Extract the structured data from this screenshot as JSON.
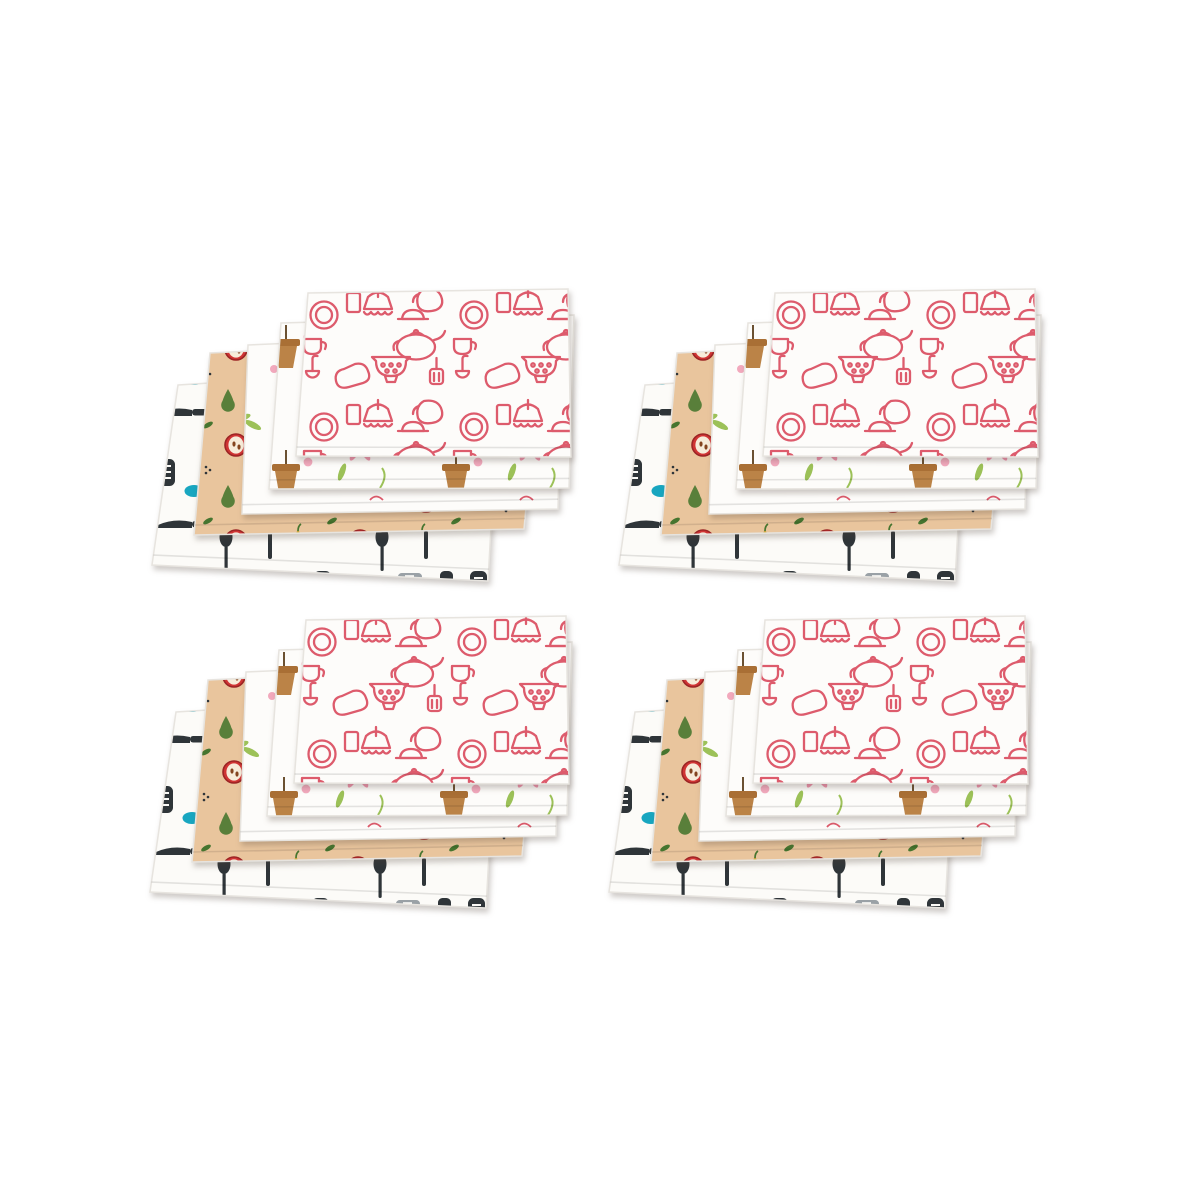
{
  "scene": {
    "background": "#ffffff",
    "subject": "four identical fanned stacks of five printed kitchen towels",
    "grid": "2x2",
    "stack_count": 4,
    "towels_per_stack": 5
  },
  "palette": {
    "towel_white": "#fdfcfa",
    "utensil_bg": "#fcfbf8",
    "jar_white": "#f8f4ec",
    "red_outline": "#dd5b6c",
    "flower_pink": "#f093ad",
    "flower_deep": "#e4647f",
    "tulip_pink": "#e97790",
    "blush_dot": "#f2a9bd",
    "leaf_green": "#9cc158",
    "dark_leaf": "#46752f",
    "pot_brown": "#bb8347",
    "pot_rim": "#a96f35",
    "stick": "#6b5132",
    "sprig_tan": "#dfb183",
    "purple_stripe": "#7b4b90",
    "yellow_stripe": "#c7a23d",
    "beige": "#e9c59d",
    "apple_red": "#d03434",
    "apple_dark": "#9c2424",
    "apple_flesh": "#f7ecda",
    "seed_brown": "#84451f",
    "pear_yellow": "#f1d83e",
    "pear_outline": "#c8a437",
    "pear_green": "#597f3a",
    "charcoal": "#2f3539",
    "utensil_gray": "#9aa1a6",
    "teal": "#18a6c0",
    "hem": "#e7e4df"
  },
  "stacks": [
    {
      "id": "towel-stack-top-left",
      "x": 150,
      "y": 285
    },
    {
      "id": "towel-stack-top-right",
      "x": 617,
      "y": 285
    },
    {
      "id": "towel-stack-bottom-left",
      "x": 148,
      "y": 612
    },
    {
      "id": "towel-stack-bottom-right",
      "x": 607,
      "y": 612
    }
  ],
  "towels": [
    {
      "name": "towel-black-utensils-print",
      "pattern": "utensils",
      "quad": [
        [
          28,
          100
        ],
        [
          350,
          80
        ],
        [
          338,
          296
        ],
        [
          2,
          280
        ]
      ]
    },
    {
      "name": "towel-beige-fruits-print",
      "pattern": "fruits",
      "quad": [
        [
          60,
          68
        ],
        [
          392,
          52
        ],
        [
          374,
          244
        ],
        [
          44,
          250
        ]
      ]
    },
    {
      "name": "towel-white-jars-print",
      "pattern": "jars",
      "quad": [
        [
          98,
          60
        ],
        [
          412,
          46
        ],
        [
          408,
          224
        ],
        [
          92,
          229
        ]
      ]
    },
    {
      "name": "towel-white-floral-print",
      "pattern": "floral",
      "quad": [
        [
          131,
          38
        ],
        [
          424,
          30
        ],
        [
          419,
          203
        ],
        [
          119,
          204
        ]
      ]
    },
    {
      "name": "towel-red-kitchen-doodles-print",
      "pattern": "doodles",
      "quad": [
        [
          158,
          8
        ],
        [
          418,
          4
        ],
        [
          421,
          172
        ],
        [
          146,
          171
        ]
      ]
    }
  ]
}
